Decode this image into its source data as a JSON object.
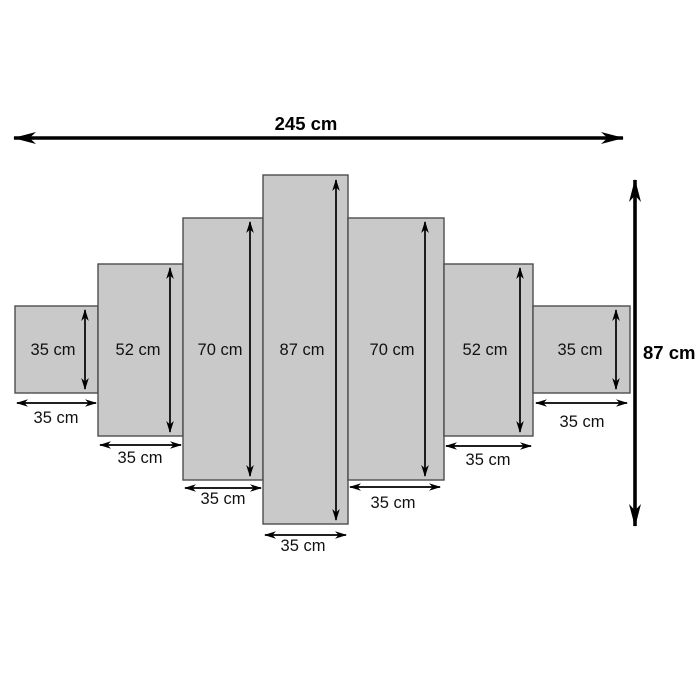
{
  "diagram": {
    "overall_width": {
      "label": "245 cm",
      "value_cm": 245
    },
    "overall_height": {
      "label": "87 cm",
      "value_cm": 87
    },
    "panels": [
      {
        "position": "far-left",
        "height_label": "35 cm",
        "width_label": "35 cm",
        "height_cm": 35,
        "width_cm": 35
      },
      {
        "position": "left-2",
        "height_label": "52 cm",
        "width_label": "35 cm",
        "height_cm": 52,
        "width_cm": 35
      },
      {
        "position": "left-3",
        "height_label": "70 cm",
        "width_label": "35 cm",
        "height_cm": 70,
        "width_cm": 35
      },
      {
        "position": "center",
        "height_label": "87 cm",
        "width_label": "35 cm",
        "height_cm": 87,
        "width_cm": 35
      },
      {
        "position": "right-3",
        "height_label": "70 cm",
        "width_label": "35 cm",
        "height_cm": 70,
        "width_cm": 35
      },
      {
        "position": "right-2",
        "height_label": "52 cm",
        "width_label": "35 cm",
        "height_cm": 52,
        "width_cm": 35
      },
      {
        "position": "far-right",
        "height_label": "35 cm",
        "width_label": "35 cm",
        "height_cm": 35,
        "width_cm": 35
      }
    ],
    "colors": {
      "panel_fill": "#c9c9c9",
      "panel_border": "#4d4d4d",
      "arrow": "#000000",
      "background": "#ffffff"
    }
  }
}
